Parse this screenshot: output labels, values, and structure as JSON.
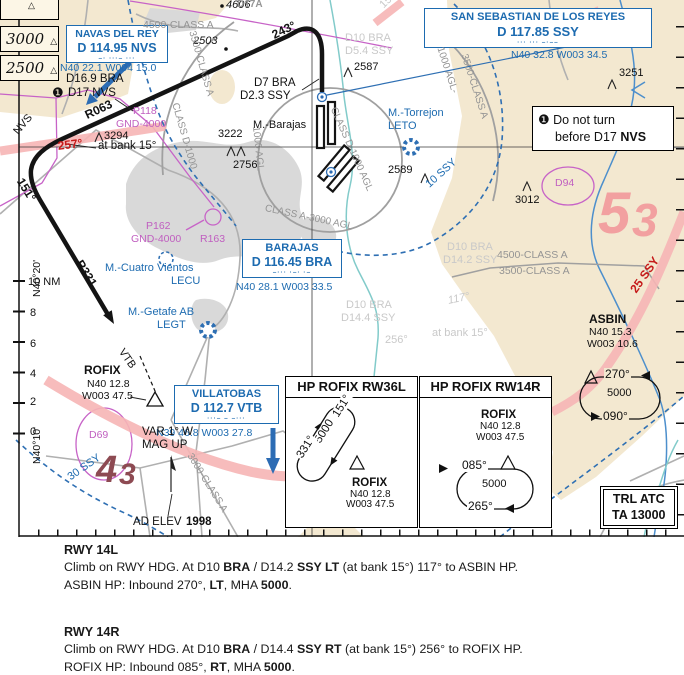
{
  "legend": {
    "alt1": "3000",
    "alt2": "2500",
    "sym": "△"
  },
  "navaids": {
    "nvs": {
      "name": "NAVAS DEL REY",
      "freq": "D 114.95 NVS",
      "morse": "–·  ···–  ···",
      "coords": "N40 22.1 W004 15.0"
    },
    "ssy": {
      "name": "SAN SEBASTIAN DE LOS REYES",
      "freq": "D 117.85 SSY",
      "morse": "···  ···  –·––",
      "coords": "N40 32.8 W003 34.5"
    },
    "bra": {
      "name": "BARAJAS",
      "freq": "D 116.45 BRA",
      "morse": "–···  ·–·  ·–",
      "coords": "N40 28.1 W003 33.5"
    },
    "vtb": {
      "name": "VILLATOBAS",
      "freq": "D 112.7 VTB",
      "morse": "···–  –  –···",
      "coords": "N39 46.8 W003 27.8"
    }
  },
  "note": {
    "badge": "❶",
    "l1": "Do not turn",
    "l2": "before D17 ",
    "l2b": "NVS"
  },
  "hp": {
    "a_title": "HP ROFIX RW36L",
    "b_title": "HP ROFIX RW14R"
  },
  "trl": {
    "l1": "TRL ATC",
    "l2": "TA 13000"
  },
  "procedures": {
    "r14l": {
      "title": "RWY 14L",
      "c1": "Climb on RWY HDG. At D10 ",
      "c2": "BRA",
      "c3": " / D14.2 ",
      "c4": "SSY LT",
      "c5": " (at bank 15°) 117° to ASBIN HP.",
      "d1": "ASBIN HP: Inbound 270°, ",
      "d2": "LT",
      "d3": ", MHA ",
      "d4": "5000",
      "d5": "."
    },
    "r14r": {
      "title": "RWY 14R",
      "c1": "Climb on RWY HDG. At D10 ",
      "c2": "BRA",
      "c3": " / D14.4 ",
      "c4": "SSY RT",
      "c5": " (at bank 15°) 256° to ROFIX HP.",
      "d1": "ROFIX HP: Inbound 085°, ",
      "d2": "RT",
      "d3": ", MHA ",
      "d4": "5000",
      "d5": "."
    }
  },
  "map": {
    "labels": [
      {
        "n": "legend-partial-sym",
        "t": "△",
        "x": 28,
        "y": 1,
        "fs": 9
      },
      {
        "n": "spot-4606",
        "t": "4606",
        "x": 226,
        "y": 0,
        "c": "it"
      },
      {
        "n": "area-d17a",
        "t": "D17A",
        "x": 237,
        "y": 0,
        "c": "gray b",
        "fs": 10
      },
      {
        "n": "class-4500-topleft",
        "t": "4500-CLASS A",
        "x": 143,
        "y": 20,
        "c": "gray",
        "fs": 10.5
      },
      {
        "n": "spot-2503",
        "t": "2503",
        "x": 193,
        "y": 36,
        "c": "it"
      },
      {
        "n": "track-243",
        "t": "243°",
        "x": 270,
        "y": 30,
        "c": "b",
        "fs": 12,
        "r": -26
      },
      {
        "n": "fix-d7bra",
        "t": "D7 BRA",
        "x": 254,
        "y": 77,
        "fs": 11.5
      },
      {
        "n": "fix-d23ssy",
        "t": "D2.3 SSY",
        "x": 240,
        "y": 90,
        "fs": 11.5
      },
      {
        "n": "fix-d169bra",
        "t": "D16.9 BRA",
        "x": 66,
        "y": 73,
        "fs": 11.5
      },
      {
        "n": "note1-badge-map",
        "t": "❶",
        "x": 52,
        "y": 86,
        "fs": 13
      },
      {
        "n": "fix-d17nvs",
        "t": "D17 NVS",
        "x": 68,
        "y": 87,
        "fs": 11.5
      },
      {
        "n": "radial-r063",
        "t": "R063",
        "x": 83,
        "y": 110,
        "c": "b",
        "fs": 12,
        "r": -25
      },
      {
        "n": "ra-p118",
        "t": "P118",
        "x": 133,
        "y": 106,
        "c": "mag",
        "fs": 10.5
      },
      {
        "n": "ra-p118-alt",
        "t": "GND-4000",
        "x": 116,
        "y": 119,
        "c": "mag",
        "fs": 10.5
      },
      {
        "n": "obst-3294",
        "t": "3294",
        "x": 104,
        "y": 131
      },
      {
        "n": "spot-3222",
        "t": "3222",
        "x": 218,
        "y": 129
      },
      {
        "n": "obst-2756",
        "t": "2756",
        "x": 233,
        "y": 160
      },
      {
        "n": "apt-barajas-name",
        "t": "M.-Barajas",
        "x": 253,
        "y": 120
      },
      {
        "n": "track-nvs",
        "t": "NVS",
        "x": 12,
        "y": 130,
        "r": -50
      },
      {
        "n": "track-257",
        "t": "257°",
        "x": 57,
        "y": 140,
        "c": "red",
        "fs": 12,
        "r": -7
      },
      {
        "n": "note-bank15",
        "t": "at bank 15°",
        "x": 98,
        "y": 140,
        "fs": 11.5
      },
      {
        "n": "track-151",
        "t": "151°",
        "x": 25,
        "y": 176,
        "c": "b",
        "fs": 12,
        "r": 58
      },
      {
        "n": "apt-torrejon-name",
        "t": "M.-Torrejon",
        "x": 388,
        "y": 108,
        "c": "blue"
      },
      {
        "n": "apt-torrejon-code",
        "t": "LETO",
        "x": 388,
        "y": 121,
        "c": "blue"
      },
      {
        "n": "obst-2587",
        "t": "2587",
        "x": 354,
        "y": 62
      },
      {
        "n": "obst-2589",
        "t": "2589",
        "x": 388,
        "y": 165
      },
      {
        "n": "obst-3251",
        "t": "3251",
        "x": 619,
        "y": 68
      },
      {
        "n": "ra-d94",
        "t": "D94",
        "x": 555,
        "y": 178,
        "c": "mag",
        "fs": 10.5
      },
      {
        "n": "obst-3012",
        "t": "3012",
        "x": 515,
        "y": 195
      },
      {
        "n": "mora-53-a",
        "t": "5",
        "x": 598,
        "y": 184,
        "c": "salmon bi",
        "fs": 58
      },
      {
        "n": "mora-53-b",
        "t": "3",
        "x": 632,
        "y": 196,
        "c": "salmon bi",
        "fs": 46
      },
      {
        "n": "arc-10ssy",
        "t": "10 SSY",
        "x": 424,
        "y": 182,
        "c": "blue",
        "r": -42
      },
      {
        "n": "class-3500-rot-tl",
        "t": "3500-CLASS A",
        "x": 196,
        "y": 30,
        "c": "gray",
        "fs": 10,
        "r": 74
      },
      {
        "n": "class-d1000-rot-tl",
        "t": "CLASS D-1000",
        "x": 179,
        "y": 102,
        "c": "gray",
        "fs": 10,
        "r": 74
      },
      {
        "n": "class-1000agl-rot-r",
        "t": "1000 AGL-",
        "x": 444,
        "y": 46,
        "c": "gray",
        "fs": 10,
        "r": 72
      },
      {
        "n": "class-3500-rot-r",
        "t": "3500-CLASS A",
        "x": 468,
        "y": 53,
        "c": "gray",
        "fs": 10,
        "r": 72
      },
      {
        "n": "class-d1000agl-ring",
        "t": "CLASS D-1000 AGL",
        "x": 337,
        "y": 106,
        "c": "gray",
        "fs": 10,
        "r": 66
      },
      {
        "n": "class-1000agl-ring",
        "t": "1000 AGL",
        "x": 260,
        "y": 126,
        "c": "gray",
        "fs": 10,
        "r": 84
      },
      {
        "n": "class-a3000-ring",
        "t": "CLASS A-3000 AGL",
        "x": 266,
        "y": 204,
        "c": "gray",
        "fs": 10,
        "r": 12
      },
      {
        "n": "fade-d10bra-1",
        "t": "D10 BRA",
        "x": 345,
        "y": 33,
        "c": "fade"
      },
      {
        "n": "fade-d54ssy",
        "t": "D5.4 SSY",
        "x": 345,
        "y": 46,
        "c": "fade"
      },
      {
        "n": "fade-151",
        "t": "151°",
        "x": 378,
        "y": 3,
        "c": "fade",
        "r": -45
      },
      {
        "n": "fade-d10bra-2",
        "t": "D10 BRA",
        "x": 447,
        "y": 242,
        "c": "fade"
      },
      {
        "n": "fade-d142ssy",
        "t": "D14.2 SSY",
        "x": 443,
        "y": 255,
        "c": "fade"
      },
      {
        "n": "fade-117",
        "t": "117°",
        "x": 447,
        "y": 296,
        "c": "fade it",
        "r": -12
      },
      {
        "n": "fade-d10bra-3",
        "t": "D10 BRA",
        "x": 346,
        "y": 300,
        "c": "fade"
      },
      {
        "n": "fade-d144ssy",
        "t": "D14.4 SSY",
        "x": 341,
        "y": 313,
        "c": "fade"
      },
      {
        "n": "fade-256",
        "t": "256°",
        "x": 385,
        "y": 335,
        "c": "fade"
      },
      {
        "n": "fade-bank15",
        "t": "at bank 15°",
        "x": 432,
        "y": 328,
        "c": "fade"
      },
      {
        "n": "class-4500-right",
        "t": "4500-CLASS A",
        "x": 497,
        "y": 250,
        "c": "gray",
        "fs": 10.5
      },
      {
        "n": "class-3500-right",
        "t": "3500-CLASS A",
        "x": 499,
        "y": 266,
        "c": "gray",
        "fs": 10.5
      },
      {
        "n": "arc-25ssy",
        "t": "25 SSY",
        "x": 628,
        "y": 288,
        "c": "red",
        "fs": 12,
        "r": -55
      },
      {
        "n": "wpt-asbin",
        "t": "ASBIN",
        "x": 589,
        "y": 313,
        "c": "b",
        "fs": 12
      },
      {
        "n": "wpt-asbin-lat",
        "t": "N40 15.3",
        "x": 589,
        "y": 327,
        "fs": 10.5
      },
      {
        "n": "wpt-asbin-lon",
        "t": "W003 10.6",
        "x": 587,
        "y": 339,
        "fs": 10.5
      },
      {
        "n": "hold-asbin-in",
        "t": "270°",
        "x": 604,
        "y": 368,
        "c": "bgb",
        "fs": 12
      },
      {
        "n": "hold-asbin-alt",
        "t": "5000",
        "x": 606,
        "y": 388,
        "c": "bgb"
      },
      {
        "n": "hold-asbin-out",
        "t": "090°",
        "x": 602,
        "y": 410,
        "c": "bgb",
        "fs": 12
      },
      {
        "n": "ra-p162",
        "t": "P162",
        "x": 146,
        "y": 221,
        "c": "mag",
        "fs": 10.5
      },
      {
        "n": "ra-p162-alt",
        "t": "GND-4000",
        "x": 131,
        "y": 234,
        "c": "mag",
        "fs": 10.5
      },
      {
        "n": "ra-r163",
        "t": "R163",
        "x": 200,
        "y": 234,
        "c": "mag",
        "fs": 10.5
      },
      {
        "n": "apt-cuatro-name",
        "t": "M.-Cuatro Vientos",
        "x": 105,
        "y": 263,
        "c": "blue"
      },
      {
        "n": "apt-cuatro-code",
        "t": "LECU",
        "x": 171,
        "y": 276,
        "c": "blue"
      },
      {
        "n": "apt-getafe-name",
        "t": "M.-Getafe AB",
        "x": 128,
        "y": 307,
        "c": "blue"
      },
      {
        "n": "apt-getafe-code",
        "t": "LEGT",
        "x": 157,
        "y": 320,
        "c": "blue"
      },
      {
        "n": "scale-10nm",
        "t": "10 NM",
        "x": 28,
        "y": 277
      },
      {
        "n": "scale-8",
        "t": "8",
        "x": 30,
        "y": 308
      },
      {
        "n": "scale-6",
        "t": "6",
        "x": 30,
        "y": 339
      },
      {
        "n": "scale-4",
        "t": "4",
        "x": 30,
        "y": 369
      },
      {
        "n": "scale-2",
        "t": "2",
        "x": 30,
        "y": 397
      },
      {
        "n": "scale-0",
        "t": "0",
        "x": 30,
        "y": 427
      },
      {
        "n": "lat-n4020",
        "t": "N40°20'",
        "x": 32,
        "y": 297,
        "fs": 10.5,
        "r": -90
      },
      {
        "n": "lat-n4010",
        "t": "N40°10'",
        "x": 32,
        "y": 464,
        "fs": 10.5,
        "r": -90
      },
      {
        "n": "radial-r331",
        "t": "R331",
        "x": 84,
        "y": 258,
        "c": "b",
        "fs": 12,
        "r": 58
      },
      {
        "n": "wpt-rofix",
        "t": "ROFIX",
        "x": 84,
        "y": 364,
        "c": "b",
        "fs": 12
      },
      {
        "n": "wpt-rofix-lat",
        "t": "N40 12.8",
        "x": 87,
        "y": 379,
        "fs": 10.5
      },
      {
        "n": "wpt-rofix-lon",
        "t": "W003 47.5",
        "x": 82,
        "y": 391,
        "fs": 10.5
      },
      {
        "n": "track-vtb",
        "t": "VTB",
        "x": 125,
        "y": 347,
        "r": 55
      },
      {
        "n": "ra-d69",
        "t": "D69",
        "x": 89,
        "y": 430,
        "c": "mag",
        "fs": 10.5
      },
      {
        "n": "mora-43-a",
        "t": "4",
        "x": 96,
        "y": 451,
        "c": "maroon bi",
        "fs": 38
      },
      {
        "n": "mora-43-b",
        "t": "3",
        "x": 119,
        "y": 459,
        "c": "maroon bi",
        "fs": 30
      },
      {
        "n": "note-var",
        "t": "VAR 1° W",
        "x": 142,
        "y": 426,
        "fs": 11.5
      },
      {
        "n": "note-mag",
        "t": "MAG UP",
        "x": 142,
        "y": 439,
        "fs": 11.5
      },
      {
        "n": "arc-30ssy",
        "t": "30 SSY",
        "x": 66,
        "y": 474,
        "c": "blue",
        "r": -35
      },
      {
        "n": "note-adelev",
        "t": "AD ELEV",
        "x": 133,
        "y": 516,
        "fs": 11.5
      },
      {
        "n": "note-adelev-val",
        "t": "1998",
        "x": 186,
        "y": 516,
        "c": "b",
        "fs": 11.5
      },
      {
        "n": "class-3000-rot",
        "t": "3000-CLASS A",
        "x": 193,
        "y": 452,
        "c": "gray",
        "fs": 10,
        "r": 58
      },
      {
        "n": "hpa-crs-in",
        "t": "151°",
        "x": 330,
        "y": 414,
        "c": "bgw",
        "fs": 11.5,
        "r": -58
      },
      {
        "n": "hpa-alt",
        "t": "5000",
        "x": 312,
        "y": 440,
        "c": "bgw",
        "fs": 11.5,
        "r": -58
      },
      {
        "n": "hpa-crs-out",
        "t": "331°",
        "x": 294,
        "y": 455,
        "c": "bgw",
        "fs": 11.5,
        "r": -58
      },
      {
        "n": "hpa-fix",
        "t": "ROFIX",
        "x": 352,
        "y": 477,
        "c": "b",
        "fs": 11.5
      },
      {
        "n": "hpa-fix-lat",
        "t": "N40 12.8",
        "x": 350,
        "y": 490,
        "fs": 10
      },
      {
        "n": "hpa-fix-lon",
        "t": "W003 47.5",
        "x": 346,
        "y": 500,
        "fs": 10
      },
      {
        "n": "hpb-fix",
        "t": "ROFIX",
        "x": 481,
        "y": 409,
        "c": "b",
        "fs": 11.5
      },
      {
        "n": "hpb-fix-lat",
        "t": "N40 12.8",
        "x": 480,
        "y": 422,
        "fs": 10
      },
      {
        "n": "hpb-fix-lon",
        "t": "W003 47.5",
        "x": 476,
        "y": 433,
        "fs": 10
      },
      {
        "n": "hpb-crs-in",
        "t": "085°",
        "x": 461,
        "y": 459,
        "c": "bgw",
        "fs": 12
      },
      {
        "n": "hpb-alt",
        "t": "5000",
        "x": 481,
        "y": 479,
        "c": "bgw"
      },
      {
        "n": "hpb-crs-out",
        "t": "265°",
        "x": 467,
        "y": 500,
        "c": "bgw",
        "fs": 12
      }
    ]
  }
}
